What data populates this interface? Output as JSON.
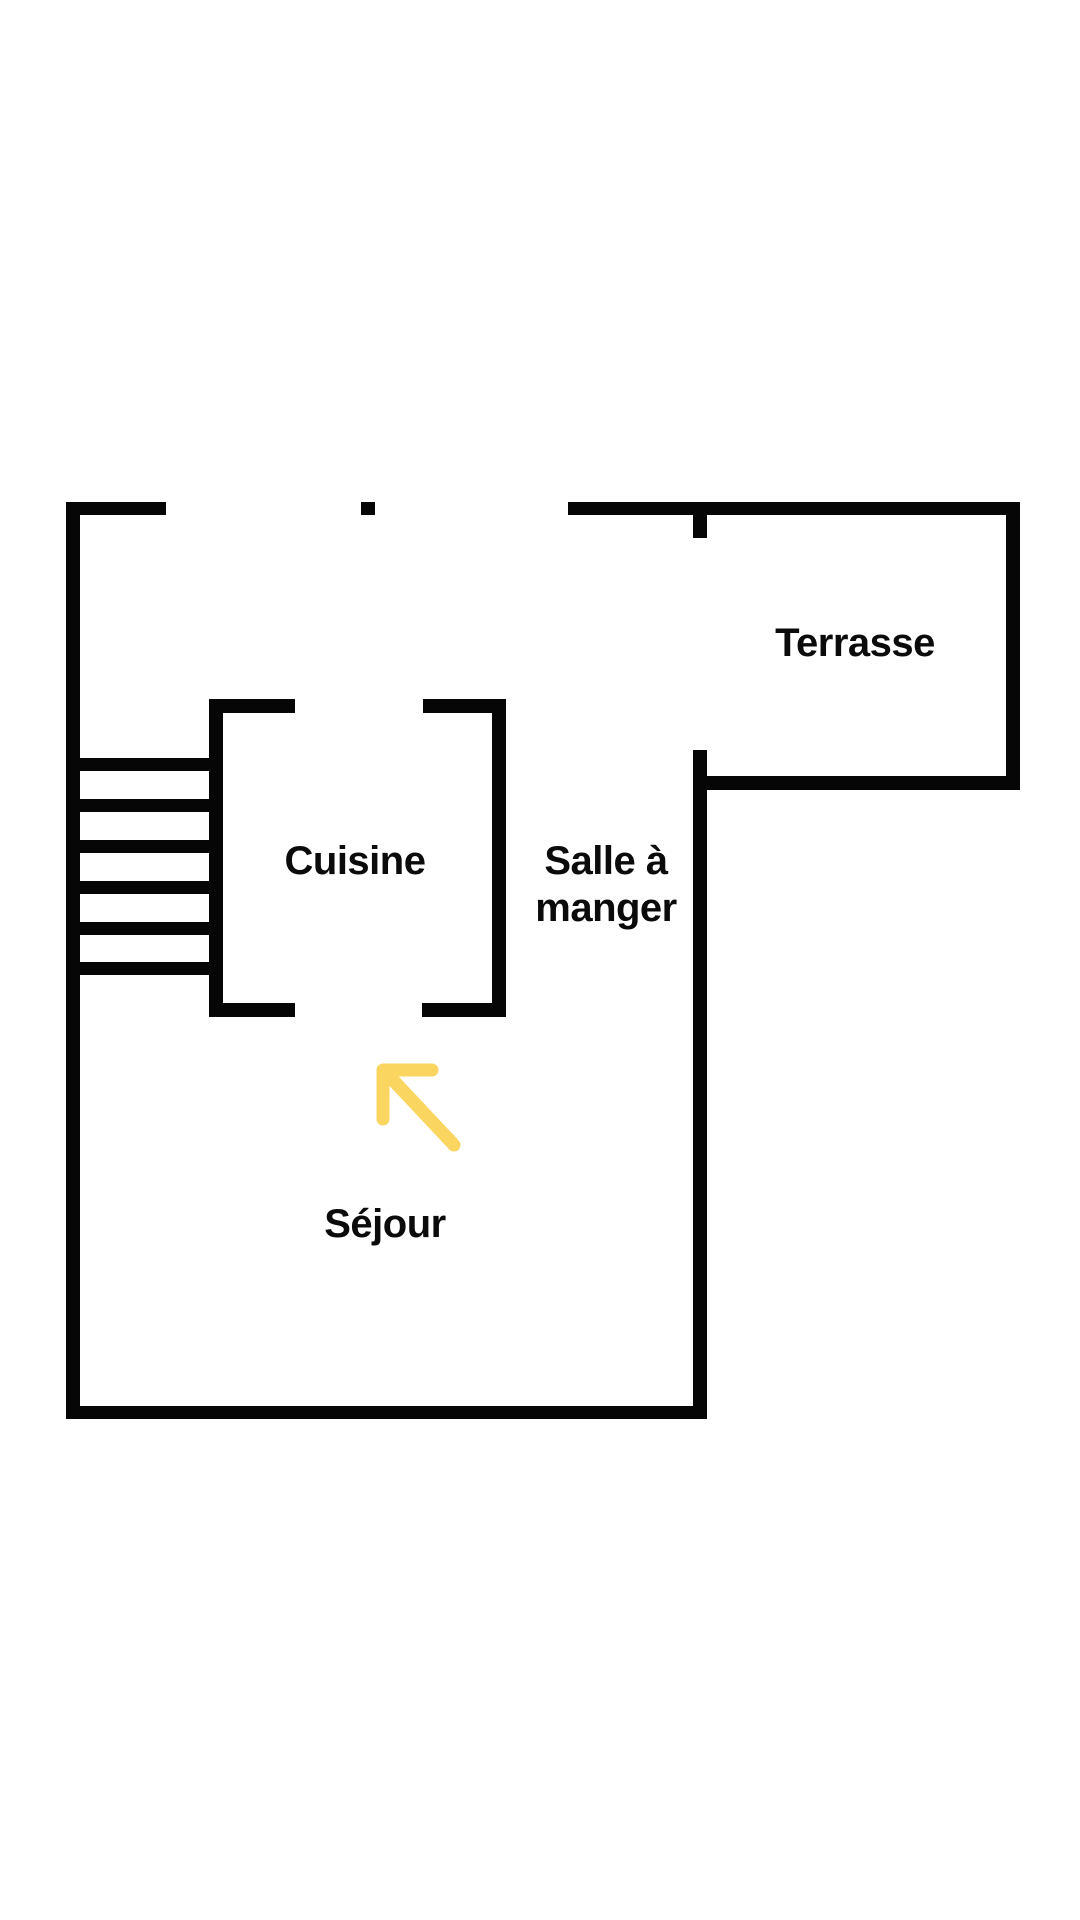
{
  "page": {
    "background_color": "#ffffff"
  },
  "plan": {
    "wall_color": "#060606",
    "rooms": [
      {
        "id": "terrasse",
        "label": "Terrasse"
      },
      {
        "id": "cuisine",
        "label": "Cuisine"
      },
      {
        "id": "salle-a-manger",
        "label": "Salle à manger",
        "lines": [
          "Salle à",
          "manger"
        ]
      },
      {
        "id": "sejour",
        "label": "Séjour"
      }
    ],
    "stairs": {
      "step_count": 6
    },
    "arrow": {
      "color": "#FAD55F",
      "direction": "up-left"
    }
  }
}
